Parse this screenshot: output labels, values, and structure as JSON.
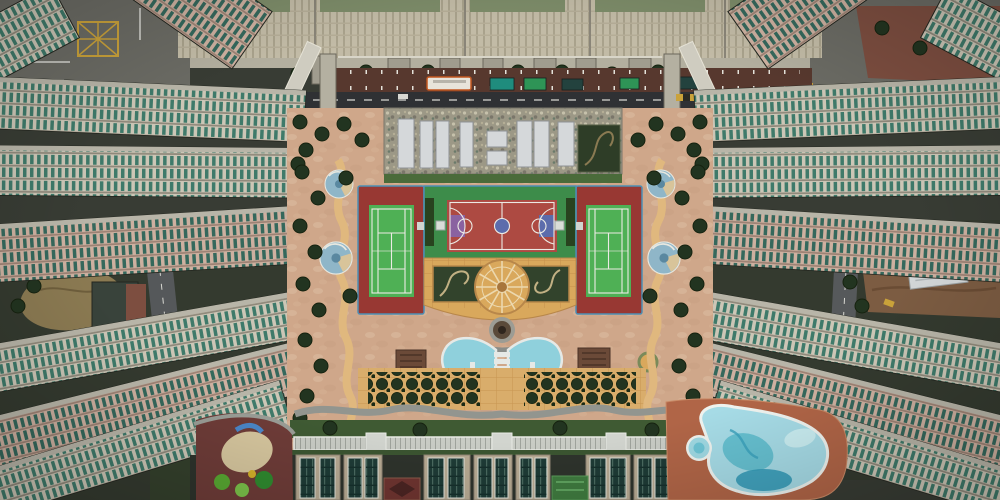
{
  "scene": {
    "type": "aerial-photograph",
    "description": "Top-down drone photograph of a dense high-rise housing estate: tower slabs radiate from a central podium courtyard containing two green tennis courts, a red basketball court, an amber mosaic plaza with a wheel motif, a fan-shaped fountain pool, tree grids, a long glass canopy walkway, a children's playground and a free-form swimming pool; a service road with a bus and container trucks runs along the top.",
    "features": [
      "high-rise residential tower slabs",
      "teal glass window facades",
      "service road with bus and trucks",
      "skylight roof deck",
      "tennis courts",
      "basketball court",
      "amber wheel plaza",
      "sunken gardens",
      "fan fountain pool",
      "tree grid",
      "glass canopy walkway",
      "children's playground",
      "free-form swimming pool",
      "construction lot"
    ]
  },
  "colors": {
    "base_ground": "#383c34",
    "ground_side": "#343a2f",
    "road_gray": "#6b6b64",
    "asphalt": "#2f3134",
    "curb": "#8a887c",
    "parking_maroon": "#57382e",
    "facade_beige": "#c2bba6",
    "facade_rib": "#a9a28c",
    "roof_green": "#7d8c69",
    "concrete_light": "#b3af9f",
    "vent_box": "#a09c8e",
    "pillar": "#b4b0a1",
    "bridge_light": "#cfccc0",
    "bus_body": "#e8e4da",
    "bus_orange": "#c4571f",
    "truck_teal": "#1f8c7d",
    "truck_green": "#2e9456",
    "truck_dark": "#23423e",
    "car_white": "#d8d8d2",
    "mullion_light": "#ccc6b6",
    "mullion_pink": "#cdb0a0",
    "glass_teal": "#3f7a6a",
    "glass_teal_dark": "#35685c",
    "floor_line": "#8f897b",
    "floor_line_pink": "#9c8274",
    "slab_roof_edge": "#b8b5a8",
    "slab_outline": "#23261f",
    "dirt_brown": "#8b7a52",
    "lot_brown": "#7c5c42",
    "tarp_white": "#d3d7d8",
    "dark_roof": "#39433b",
    "brick_red": "#7d4e40",
    "podium_pink": "#cfa78a",
    "paving_cream": "#e3cdb2",
    "paving_shadow": "#c1957b",
    "mosaic_roof": "#9c9886",
    "skylight": "#d5d8da",
    "garden_dark": "#2e3d27",
    "garden_path": "#c2b184",
    "court_pad_red": "#983833",
    "court_green_pad": "#3d8c4a",
    "tennis_green": "#4fb055",
    "bball_red": "#ad4a42",
    "key_blue": "#5c6cac",
    "key_violet": "#8a62a0",
    "line_white": "#eceae4",
    "fence_blue": "#4d8fb5",
    "hedge_dark": "#28421f",
    "bench_white": "#d9ddd8",
    "plaza_amber": "#d9a85c",
    "plaza_rim": "#b8874a",
    "spoke_cream": "#ecd8ae",
    "hub_brown": "#a8763c",
    "fountain_gray": "#9c9c94",
    "fountain_brown": "#5a4a3a",
    "fountain_core": "#2f261e",
    "fan_pool_blue": "#8fd0dc",
    "pool_step_white": "#e6e9e6",
    "tree_dark": "#223420",
    "green_strip": "#3f5a33",
    "shrub_green": "#4a6b3a",
    "path_gray": "#92958f",
    "path_tan": "#e0b87e",
    "paver_tan": "#d9ad6b",
    "tile_line": "#c08a48",
    "canopy_light": "#c9ccc5",
    "canopy_line": "#9fa39c",
    "rooftop_beige": "#b7aa93",
    "glassroof_dark": "#1e3b36",
    "glassroof_line": "#4a6a60",
    "patch_maroon": "#6e3430",
    "patch_green": "#3f7a3f",
    "playground_maroon": "#6e3c38",
    "sand": "#d6c69e",
    "crescent_blue": "#4a86c8",
    "equip_green": "#58a832",
    "equip_green2": "#7bc24a",
    "deck_terracotta": "#b06547",
    "pool_light": "#a6dbe6",
    "pool_mid": "#5fbccd",
    "pool_deep": "#2f98b5",
    "pool_pale": "#cdeef2",
    "pool_rim": "#eef2ee",
    "mosaic_blue": "#8fb6c8",
    "mosaic_tan": "#d8c49a",
    "mosaic_core": "#5a88a0",
    "hatch_yellow": "#caa23a",
    "pergola_brown": "#6b4a38"
  }
}
